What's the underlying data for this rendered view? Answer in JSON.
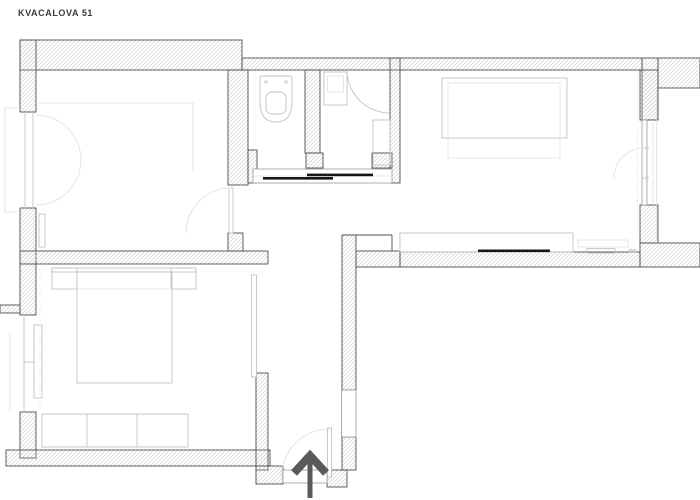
{
  "title": "KVACALOVA 51",
  "colors": {
    "background": "#ffffff",
    "wall_outline": "#4f4f4f",
    "hatch": "#c3c3c3",
    "furniture": "#c2c2c2",
    "furniture_light": "#dfdfdf",
    "black": "#161616",
    "arrow": "#5a5a5a",
    "title_text": "#3b3b3b",
    "frame": "#9a9a9a"
  },
  "plan": {
    "type": "apartment-floor-plan",
    "rooms": [
      "living-room",
      "wc",
      "bathroom",
      "bedroom-right",
      "bedroom-left",
      "hallway",
      "entrance-corridor",
      "balcony"
    ],
    "fixtures": [
      "toilet",
      "corner-shower",
      "washing-machine",
      "bathroom-cabinet",
      "double-bed",
      "bed",
      "nightstands",
      "wardrobe",
      "sideboard",
      "wall-shelf",
      "radiator",
      "casement-window",
      "window",
      "balcony-door",
      "sliding-door-wc",
      "sliding-door-bathroom",
      "room-door",
      "entrance-door",
      "entrance-arrow",
      "wall-niche"
    ]
  }
}
